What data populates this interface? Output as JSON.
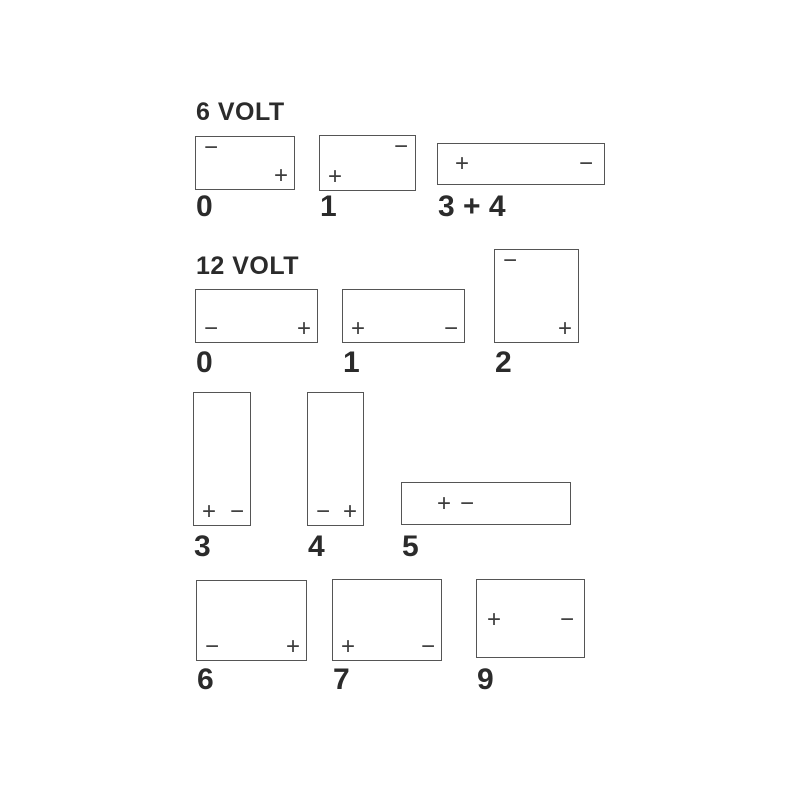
{
  "colors": {
    "background": "#ffffff",
    "line": "#555555",
    "text": "#2b2b2b",
    "symbol": "#3d3d3d"
  },
  "symbols": {
    "plus": "+",
    "minus": "−"
  },
  "sections": [
    {
      "id": "6v",
      "title": "6 VOLT",
      "boxes": [
        {
          "code": "0",
          "x": 195,
          "y": 136,
          "w": 100,
          "h": 54,
          "label_y": 192,
          "terminals": [
            {
              "type": "minus",
              "position": "top-left"
            },
            {
              "type": "plus",
              "position": "bottom-right"
            }
          ]
        },
        {
          "code": "1",
          "x": 319,
          "y": 135,
          "w": 97,
          "h": 56,
          "label_y": 192,
          "terminals": [
            {
              "type": "minus",
              "position": "top-right"
            },
            {
              "type": "plus",
              "position": "bottom-left"
            }
          ]
        },
        {
          "code": "3 + 4",
          "x": 437,
          "y": 143,
          "w": 168,
          "h": 42,
          "label_y": 192,
          "terminals": [
            {
              "type": "plus",
              "position": "mid-left"
            },
            {
              "type": "minus",
              "position": "mid-right"
            }
          ]
        }
      ]
    },
    {
      "id": "12v",
      "title": "12 VOLT",
      "boxes": [
        {
          "code": "0",
          "x": 195,
          "y": 289,
          "w": 123,
          "h": 54,
          "label_y": 348,
          "terminals": [
            {
              "type": "minus",
              "position": "bottom-left"
            },
            {
              "type": "plus",
              "position": "bottom-right"
            }
          ]
        },
        {
          "code": "1",
          "x": 342,
          "y": 289,
          "w": 123,
          "h": 54,
          "label_y": 348,
          "terminals": [
            {
              "type": "plus",
              "position": "bottom-left"
            },
            {
              "type": "minus",
              "position": "bottom-right"
            }
          ]
        },
        {
          "code": "2",
          "x": 494,
          "y": 249,
          "w": 85,
          "h": 94,
          "label_y": 348,
          "terminals": [
            {
              "type": "minus",
              "position": "top-left"
            },
            {
              "type": "plus",
              "position": "bottom-right"
            }
          ]
        },
        {
          "code": "3",
          "x": 193,
          "y": 392,
          "w": 58,
          "h": 134,
          "label_y": 532,
          "terminals": [
            {
              "type": "plus",
              "position": "bottom-left"
            },
            {
              "type": "minus",
              "position": "bottom-right"
            }
          ]
        },
        {
          "code": "4",
          "x": 307,
          "y": 392,
          "w": 57,
          "h": 134,
          "label_y": 532,
          "terminals": [
            {
              "type": "minus",
              "position": "bottom-left"
            },
            {
              "type": "plus",
              "position": "bottom-right"
            }
          ]
        },
        {
          "code": "5",
          "x": 401,
          "y": 482,
          "w": 170,
          "h": 43,
          "label_y": 532,
          "terminals": [
            {
              "type": "plus",
              "position": "mid-pair-1"
            },
            {
              "type": "minus",
              "position": "mid-pair-2"
            }
          ]
        },
        {
          "code": "6",
          "x": 196,
          "y": 580,
          "w": 111,
          "h": 81,
          "label_y": 665,
          "terminals": [
            {
              "type": "minus",
              "position": "bottom-left"
            },
            {
              "type": "plus",
              "position": "bottom-right"
            }
          ]
        },
        {
          "code": "7",
          "x": 332,
          "y": 579,
          "w": 110,
          "h": 82,
          "label_y": 665,
          "terminals": [
            {
              "type": "plus",
              "position": "bottom-left"
            },
            {
              "type": "minus",
              "position": "bottom-right"
            }
          ]
        },
        {
          "code": "9",
          "x": 476,
          "y": 579,
          "w": 109,
          "h": 79,
          "label_y": 665,
          "terminals": [
            {
              "type": "plus",
              "position": "upper-left"
            },
            {
              "type": "minus",
              "position": "upper-right"
            }
          ]
        }
      ]
    }
  ]
}
